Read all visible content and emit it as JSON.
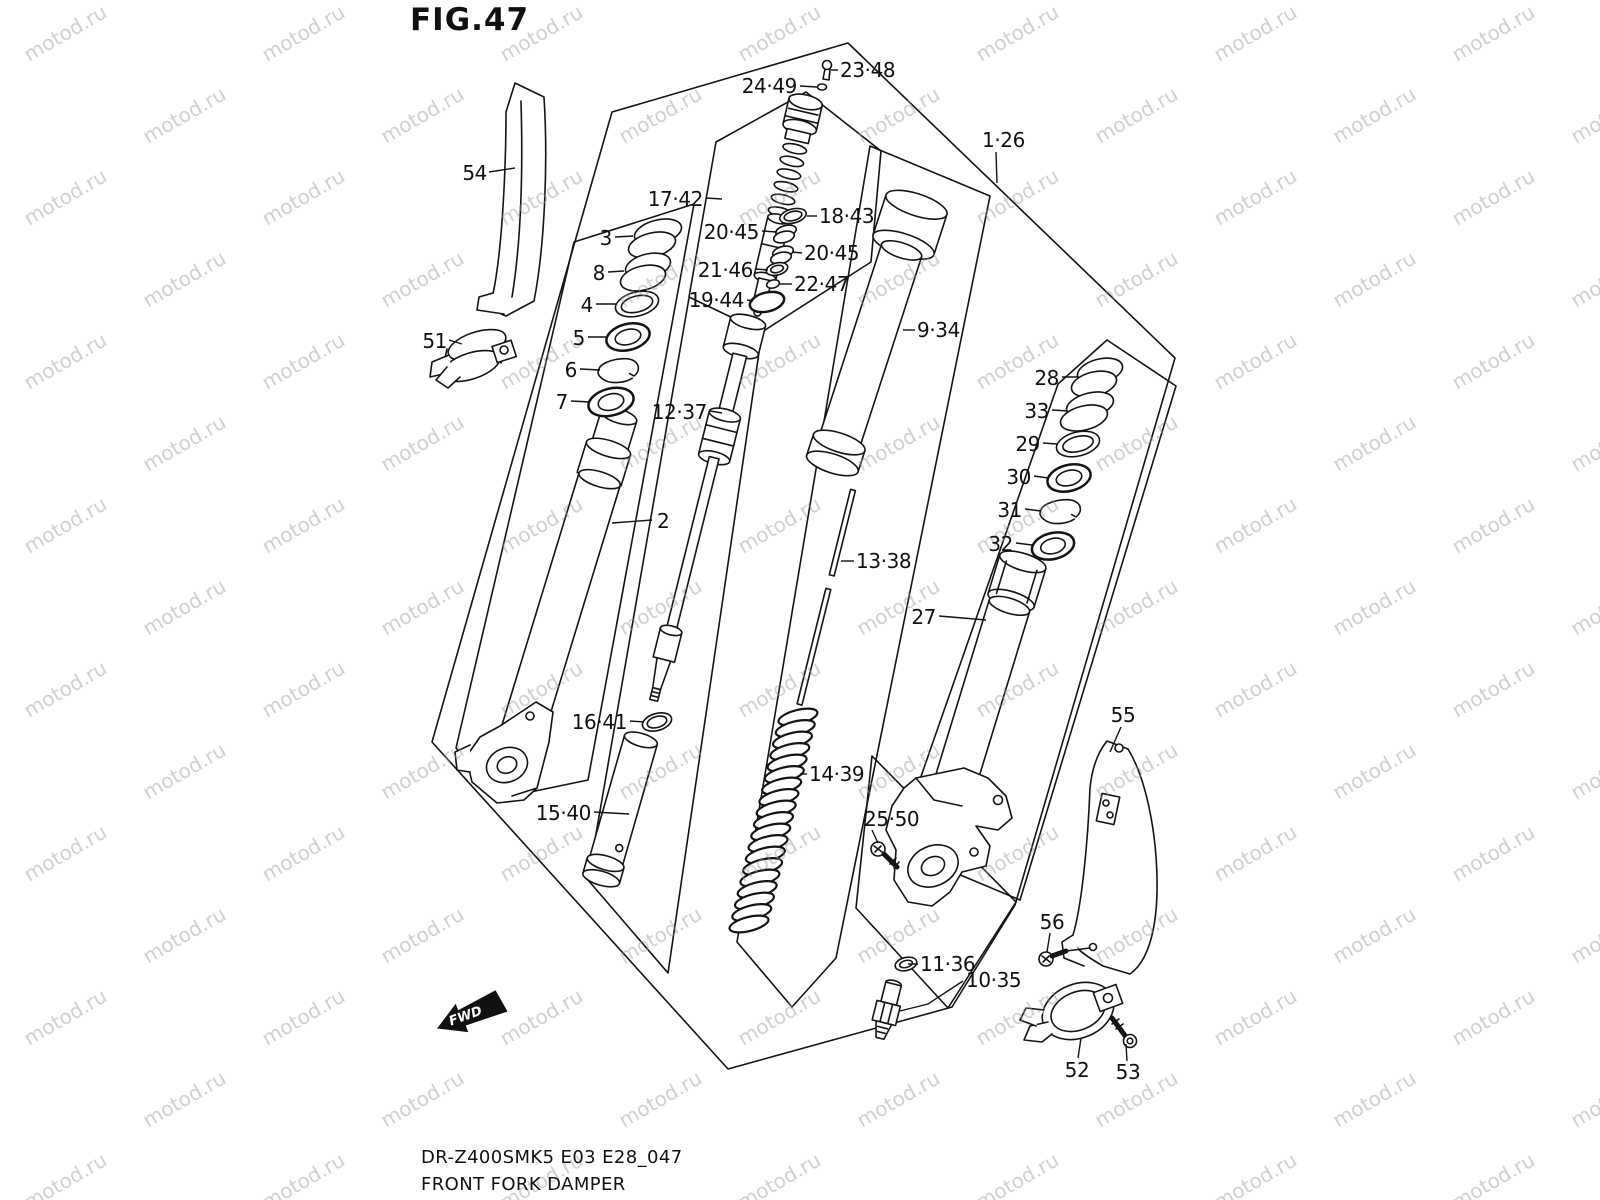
{
  "title": "FIG.47",
  "footer": {
    "model_code": "DR-Z400SMK5 E03 E28_047",
    "caption": "FRONT FORK DAMPER"
  },
  "fwd_arrow": {
    "label": "FWD"
  },
  "watermark": {
    "text": "motod.ru",
    "color": "#9a9a9a",
    "opacity": 0.45,
    "angle": -30,
    "font_size": 20,
    "x_step": 238,
    "y_step": 82
  },
  "ink_color": "#141414",
  "labels": [
    {
      "text": "54",
      "tx": 487,
      "ty": 180,
      "anchor": "end",
      "leader": [
        [
          489,
          172
        ],
        [
          515,
          168
        ]
      ]
    },
    {
      "text": "51",
      "tx": 447,
      "ty": 348,
      "anchor": "end",
      "leader": [
        [
          449,
          340
        ],
        [
          462,
          344
        ]
      ]
    },
    {
      "text": "3",
      "tx": 612,
      "ty": 245,
      "anchor": "end",
      "leader": [
        [
          615,
          237
        ],
        [
          633,
          236
        ]
      ]
    },
    {
      "text": "8",
      "tx": 605,
      "ty": 280,
      "anchor": "end",
      "leader": [
        [
          608,
          272
        ],
        [
          624,
          271
        ]
      ]
    },
    {
      "text": "4",
      "tx": 593,
      "ty": 312,
      "anchor": "end",
      "leader": [
        [
          596,
          304
        ],
        [
          616,
          304
        ]
      ]
    },
    {
      "text": "5",
      "tx": 585,
      "ty": 345,
      "anchor": "end",
      "leader": [
        [
          588,
          337
        ],
        [
          607,
          337
        ]
      ]
    },
    {
      "text": "6",
      "tx": 577,
      "ty": 377,
      "anchor": "end",
      "leader": [
        [
          580,
          369
        ],
        [
          600,
          370
        ]
      ]
    },
    {
      "text": "7",
      "tx": 568,
      "ty": 409,
      "anchor": "end",
      "leader": [
        [
          571,
          401
        ],
        [
          590,
          402
        ]
      ]
    },
    {
      "text": "2",
      "tx": 657,
      "ty": 528,
      "anchor": "start",
      "leader": [
        [
          612,
          523
        ],
        [
          652,
          520
        ]
      ]
    },
    {
      "text": "17·42",
      "tx": 703,
      "ty": 206,
      "anchor": "end",
      "leader": [
        [
          706,
          198
        ],
        [
          722,
          199
        ]
      ]
    },
    {
      "text": "18·43",
      "tx": 819,
      "ty": 223,
      "anchor": "start",
      "leader": [
        [
          807,
          216
        ],
        [
          817,
          216
        ]
      ]
    },
    {
      "text": "20·45",
      "tx": 759,
      "ty": 239,
      "anchor": "end",
      "leader": [
        [
          762,
          231
        ],
        [
          777,
          232
        ]
      ]
    },
    {
      "text": "20·45",
      "tx": 804,
      "ty": 260,
      "anchor": "start",
      "leader": [
        [
          792,
          252
        ],
        [
          802,
          253
        ]
      ]
    },
    {
      "text": "21·46",
      "tx": 753,
      "ty": 277,
      "anchor": "end",
      "leader": [
        [
          756,
          269
        ],
        [
          768,
          270
        ]
      ]
    },
    {
      "text": "22·47",
      "tx": 794,
      "ty": 291,
      "anchor": "start",
      "leader": [
        [
          780,
          284
        ],
        [
          792,
          284
        ]
      ]
    },
    {
      "text": "19·44",
      "tx": 744,
      "ty": 307,
      "anchor": "end",
      "leader": [
        [
          747,
          300
        ],
        [
          753,
          301
        ]
      ]
    },
    {
      "text": "23·48",
      "tx": 840,
      "ty": 77,
      "anchor": "start",
      "leader": [
        [
          831,
          70
        ],
        [
          838,
          70
        ]
      ]
    },
    {
      "text": "24·49",
      "tx": 797,
      "ty": 93,
      "anchor": "end",
      "leader": [
        [
          800,
          86
        ],
        [
          817,
          87
        ]
      ]
    },
    {
      "text": "1·26",
      "tx": 982,
      "ty": 147,
      "anchor": "start",
      "leader": [
        [
          996,
          152
        ],
        [
          997,
          183
        ]
      ]
    },
    {
      "text": "9·34",
      "tx": 917,
      "ty": 337,
      "anchor": "start",
      "leader": [
        [
          903,
          330
        ],
        [
          915,
          330
        ]
      ]
    },
    {
      "text": "12·37",
      "tx": 707,
      "ty": 419,
      "anchor": "end",
      "leader": [
        [
          710,
          411
        ],
        [
          722,
          413
        ]
      ]
    },
    {
      "text": "13·38",
      "tx": 856,
      "ty": 568,
      "anchor": "start",
      "leader": [
        [
          841,
          561
        ],
        [
          854,
          561
        ]
      ]
    },
    {
      "text": "14·39",
      "tx": 809,
      "ty": 781,
      "anchor": "start",
      "leader": [
        [
          800,
          774
        ],
        [
          807,
          774
        ]
      ]
    },
    {
      "text": "16·41",
      "tx": 627,
      "ty": 729,
      "anchor": "end",
      "leader": [
        [
          630,
          721
        ],
        [
          644,
          722
        ]
      ]
    },
    {
      "text": "15·40",
      "tx": 591,
      "ty": 820,
      "anchor": "end",
      "leader": [
        [
          594,
          812
        ],
        [
          629,
          814
        ]
      ]
    },
    {
      "text": "27",
      "tx": 936,
      "ty": 624,
      "anchor": "end",
      "leader": [
        [
          939,
          616
        ],
        [
          986,
          620
        ]
      ]
    },
    {
      "text": "28",
      "tx": 1059,
      "ty": 385,
      "anchor": "end",
      "leader": [
        [
          1062,
          377
        ],
        [
          1079,
          377
        ]
      ]
    },
    {
      "text": "33",
      "tx": 1049,
      "ty": 418,
      "anchor": "end",
      "leader": [
        [
          1052,
          410
        ],
        [
          1068,
          411
        ]
      ]
    },
    {
      "text": "29",
      "tx": 1040,
      "ty": 451,
      "anchor": "end",
      "leader": [
        [
          1043,
          443
        ],
        [
          1057,
          444
        ]
      ]
    },
    {
      "text": "30",
      "tx": 1031,
      "ty": 484,
      "anchor": "end",
      "leader": [
        [
          1034,
          476
        ],
        [
          1048,
          478
        ]
      ]
    },
    {
      "text": "31",
      "tx": 1022,
      "ty": 517,
      "anchor": "end",
      "leader": [
        [
          1025,
          509
        ],
        [
          1041,
          511
        ]
      ]
    },
    {
      "text": "32",
      "tx": 1013,
      "ty": 551,
      "anchor": "end",
      "leader": [
        [
          1016,
          543
        ],
        [
          1032,
          545
        ]
      ]
    },
    {
      "text": "55",
      "tx": 1123,
      "ty": 722,
      "anchor": "middle",
      "leader": [
        [
          1121,
          727
        ],
        [
          1110,
          752
        ]
      ]
    },
    {
      "text": "25·50",
      "tx": 864,
      "ty": 826,
      "anchor": "start",
      "leader": [
        [
          872,
          830
        ],
        [
          878,
          843
        ]
      ]
    },
    {
      "text": "11·36",
      "tx": 920,
      "ty": 971,
      "anchor": "start",
      "leader": [
        [
          908,
          964
        ],
        [
          918,
          964
        ]
      ]
    },
    {
      "text": "10·35",
      "tx": 966,
      "ty": 987,
      "anchor": "start",
      "leader": [
        [
          963,
          981
        ],
        [
          928,
          1004
        ],
        [
          900,
          1011
        ]
      ]
    },
    {
      "text": "56",
      "tx": 1052,
      "ty": 929,
      "anchor": "middle",
      "leader": [
        [
          1050,
          933
        ],
        [
          1047,
          952
        ]
      ]
    },
    {
      "text": "52",
      "tx": 1077,
      "ty": 1077,
      "anchor": "middle",
      "leader": [
        [
          1081,
          1038
        ],
        [
          1078,
          1058
        ]
      ]
    },
    {
      "text": "53",
      "tx": 1128,
      "ty": 1079,
      "anchor": "middle",
      "leader": [
        [
          1126,
          1044
        ],
        [
          1127,
          1061
        ]
      ]
    }
  ]
}
